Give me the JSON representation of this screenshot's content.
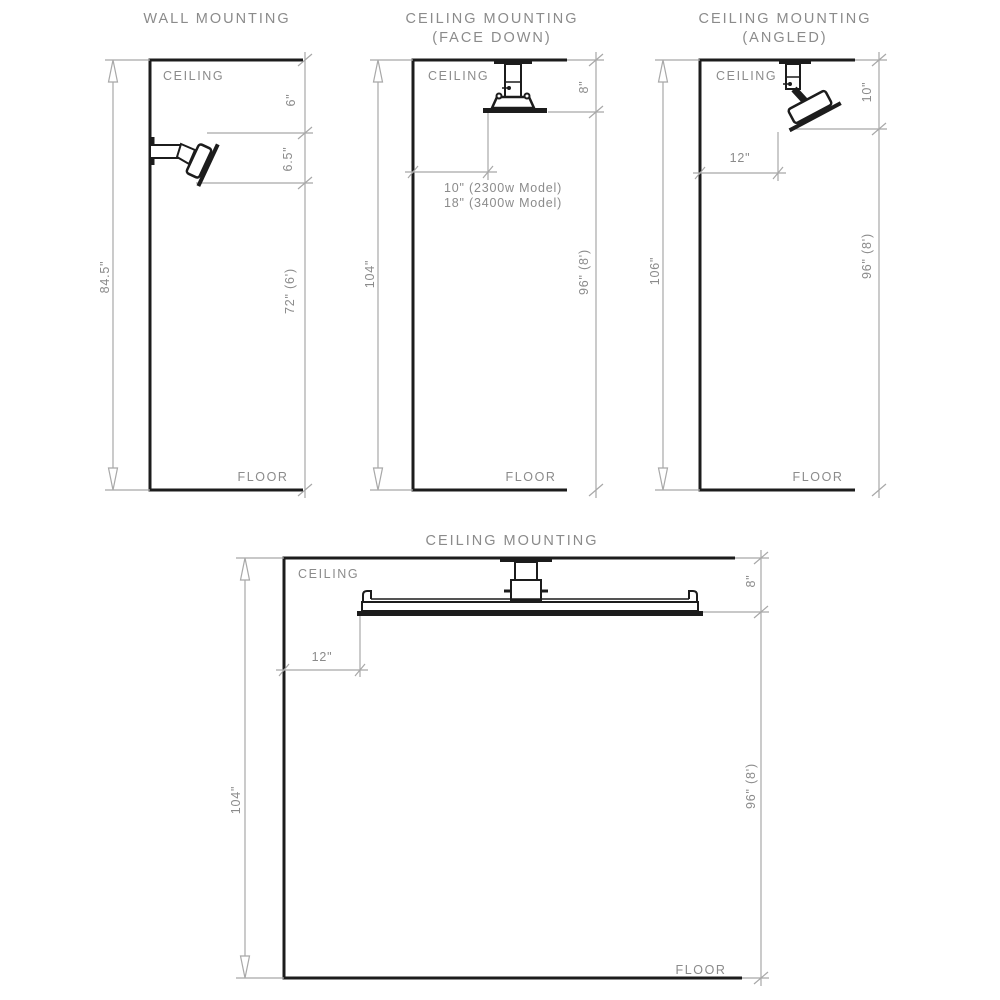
{
  "doc_type": "mounting-clearance-diagram",
  "colors": {
    "drawing_line": "#1c1c1c",
    "dimension_line": "#a8a8a8",
    "text": "#8b8b8b",
    "background": "#ffffff"
  },
  "panels": {
    "wall_mounting": {
      "title": "WALL MOUNTING",
      "ceiling": "CEILING",
      "floor": "FLOOR",
      "dim_total": "84.5\"",
      "dim_top_gap": "6\"",
      "dim_unit": "6.5\"",
      "dim_bottom": "72\" (6')"
    },
    "ceiling_face_down": {
      "title": "CEILING MOUNTING",
      "subtitle": "(FACE DOWN)",
      "ceiling": "CEILING",
      "floor": "FLOOR",
      "dim_total": "104\"",
      "dim_top_gap": "8\"",
      "dim_bottom": "96\" (8')",
      "clearance_model_1": "10\" (2300w Model)",
      "clearance_model_2": "18\" (3400w Model)"
    },
    "ceiling_angled": {
      "title": "CEILING MOUNTING",
      "subtitle": "(ANGLED)",
      "ceiling": "CEILING",
      "floor": "FLOOR",
      "dim_total": "106\"",
      "dim_top_gap": "10\"",
      "dim_wall_clearance": "12\"",
      "dim_bottom": "96\" (8')"
    },
    "ceiling_wide": {
      "title": "CEILING MOUNTING",
      "ceiling": "CEILING",
      "floor": "FLOOR",
      "dim_total": "104\"",
      "dim_top_gap": "8\"",
      "dim_wall_clearance": "12\"",
      "dim_bottom": "96\" (8')"
    }
  }
}
